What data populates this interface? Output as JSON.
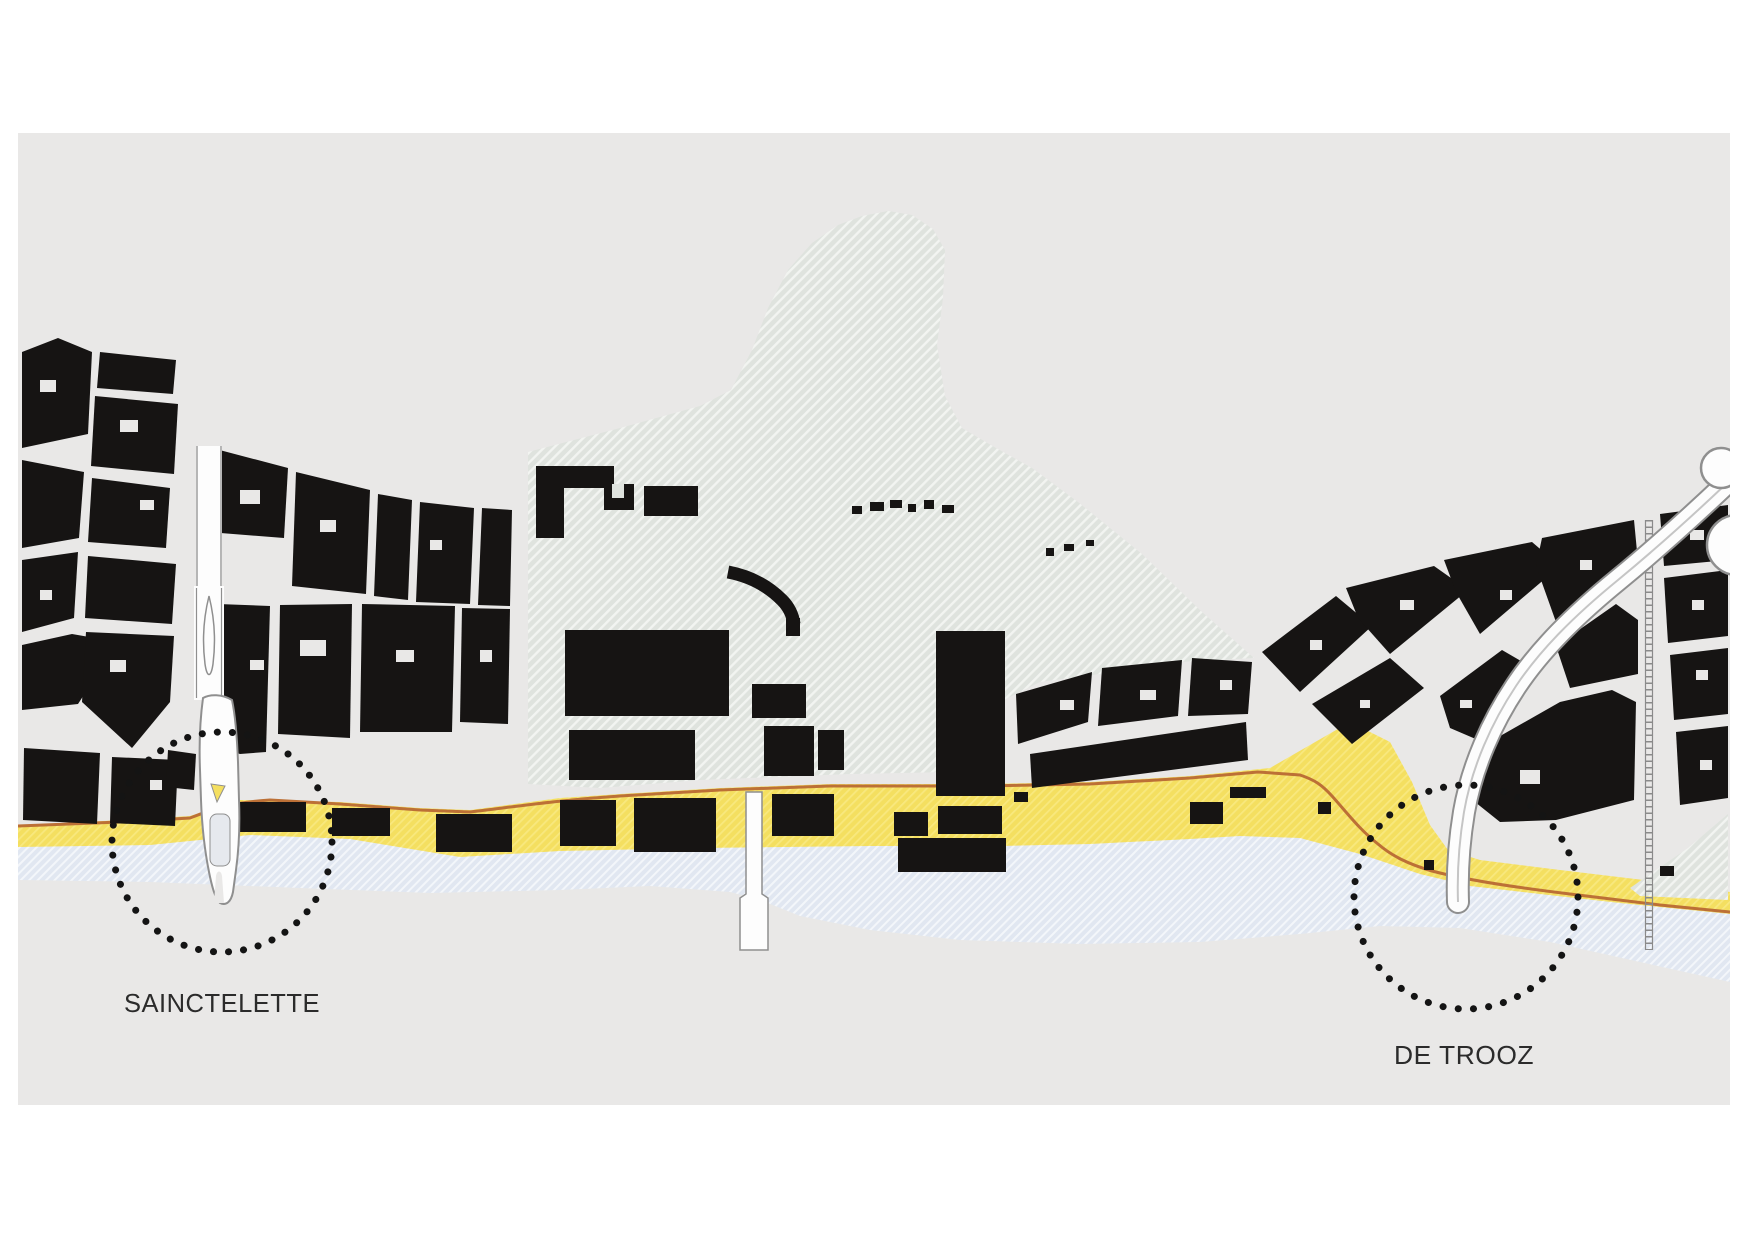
{
  "map": {
    "title": "Canal figure-ground plan",
    "labels": {
      "sainctelette": "SAINCTELETTE",
      "de_trooz": "DE TROOZ"
    },
    "annotations": {
      "left_focus": "dotted-circle highlight at Sainctelette bridge",
      "right_focus": "dotted-circle highlight at De Trooz bridge"
    },
    "features": {
      "water": "canal",
      "quay": "yellow quay strip",
      "industrial_zone": "hatched site with large sheds",
      "urban_fabric": "black building blocks",
      "railway": "railway-line",
      "bridges": [
        "sainctelette-bridge",
        "canal-footbridge",
        "de-trooz-bridge"
      ]
    }
  },
  "colors": {
    "page_bg": "#ffffff",
    "map_bg": "#e9e8e7",
    "building": "#161413",
    "hatch_base": "#dfe3de",
    "hatch_line": "#f2f4f1",
    "quay_base": "#f4df60",
    "quay_stripe": "#f8e87e",
    "quay_line": "#bc7036",
    "water_base": "#e1e7f1",
    "water_stripe": "#f3f6fa",
    "road_fill": "#fdfdfd",
    "road_stroke": "#8f8f8f",
    "rail": "#8a8a8a",
    "dot": "#141414",
    "label": "#2b2b2b"
  }
}
